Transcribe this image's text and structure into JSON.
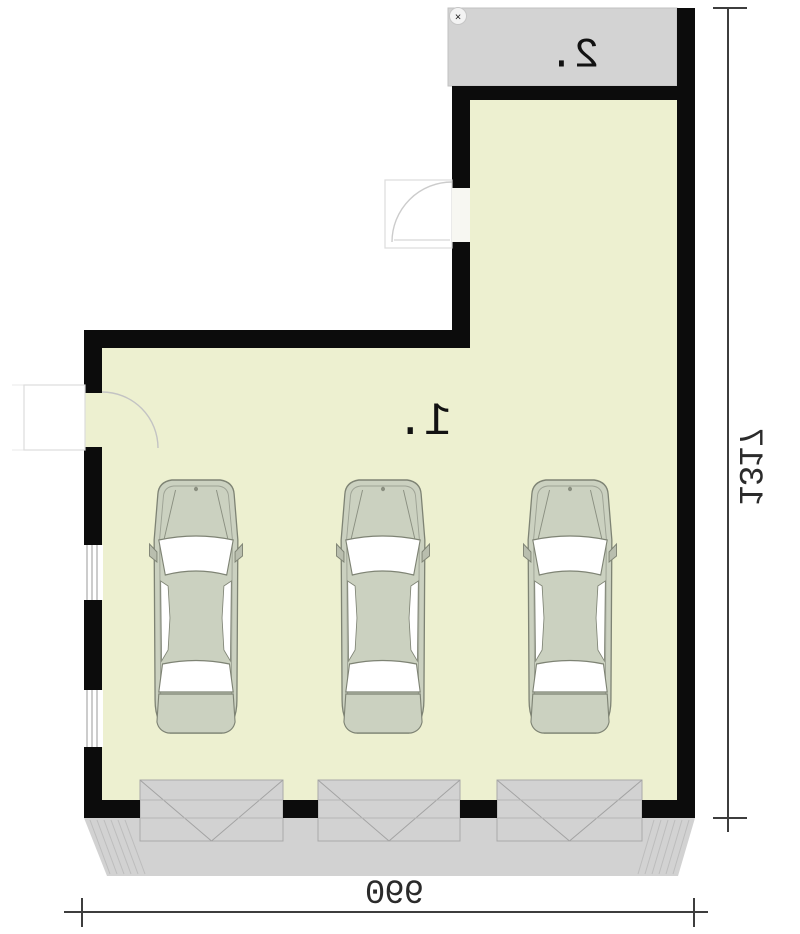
{
  "plan": {
    "type": "garage-floor-plan",
    "rooms": [
      {
        "label": "1."
      },
      {
        "label": "2."
      }
    ],
    "dimensions": {
      "bottom_width": "990",
      "right_height": "1317"
    },
    "cars": {
      "count": 3,
      "centers_x": [
        196,
        383,
        570
      ]
    },
    "garage_doors": [
      {
        "x": 140,
        "w": 143
      },
      {
        "x": 318,
        "w": 142
      },
      {
        "x": 497,
        "w": 145
      }
    ],
    "watermark_glyph": "×",
    "colors": {
      "floor": "#edf0d0",
      "wall": "#0c0c0c",
      "gray_area": "#d3d3d3",
      "car_body": "#cbd1c0",
      "car_outline": "#7e8374",
      "dim_line": "#3d3d3d",
      "door_hatch": "#a3a3a3"
    },
    "text_mirrored": true
  }
}
